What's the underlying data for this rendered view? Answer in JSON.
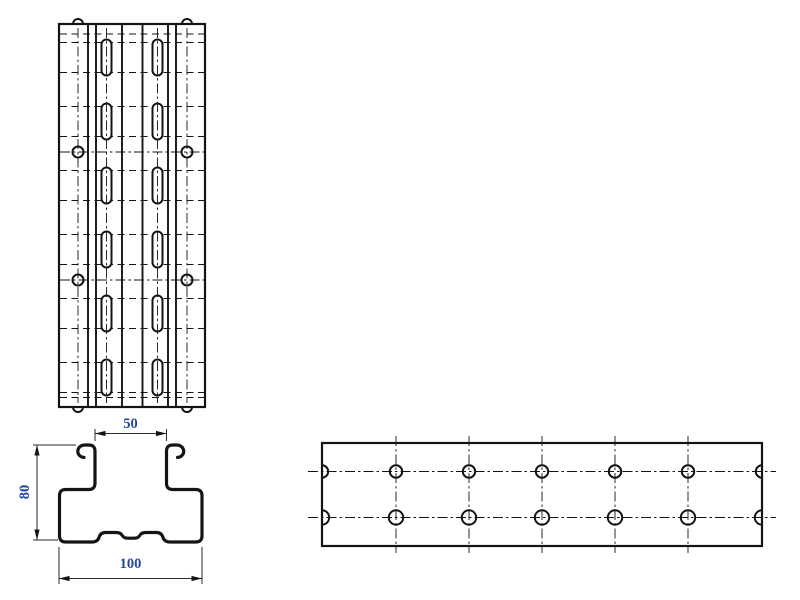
{
  "drawing": {
    "type": "engineering-orthographic-views",
    "line_color": "#141414",
    "dim_line_color": "#2a2a2a",
    "dim_text_color": "#24479b",
    "dimensions": {
      "top": {
        "label": "50"
      },
      "left": {
        "label": "80"
      },
      "bottom": {
        "label": "100"
      }
    },
    "plan_view": {
      "rect": {
        "x": 59,
        "y": 24,
        "w": 146,
        "h": 383
      },
      "solid_vertical_x": [
        88,
        96,
        122,
        142.5,
        168,
        176
      ],
      "slot_column_x": [
        106.5,
        157.5
      ],
      "slot_center_y": [
        57.5,
        121.5,
        185.5,
        249.5,
        313.5,
        377.5
      ],
      "slot_length": 36,
      "slot_width": 10,
      "slot_end_line_offset": 15,
      "extra_bend_y": [
        34,
        397.5
      ],
      "hole_column_x": [
        78,
        187
      ],
      "hole_row_y": [
        152,
        280
      ],
      "hole_radius": 5.5,
      "notch_x": [
        78,
        187
      ],
      "notch_radius": 5,
      "centerline_vertical_x": [
        78,
        106.5,
        157.5,
        187
      ]
    },
    "section_view": {
      "profile_path": "M 84,457.5 C 79,457 76.5,452.5 78.5,448.5 C 79.8,446.2 82,445 85,445 L 88.5,445 C 93,445 95,447 95,451.5 L 95,483 C 95,487.5 93,489.5 88.5,489.5 L 66,489.5 C 61.5,489.5 59.5,491.5 59.5,496 L 59.5,535.5 C 59.5,540 61.5,542 66,542 L 92,542 C 96,542 98,540.5 99,537.5 C 100,534.2 102,532.5 105.5,532.5 L 116,532.5 C 119.5,532.5 121.5,533.8 122.5,535.8 C 123.5,537.4 125,538.2 128,538.2 L 134,538.2 C 137,538.2 138.5,537.4 139.5,535.8 C 140.5,533.8 142.5,532.5 146,532.5 L 156.5,532.5 C 160,532.5 162,534.2 163,537.5 C 164,540.5 166,542 170,542 L 195.5,542 C 200,542 202,540 202,535.5 L 202,496 C 202,491.5 200,489.5 195.5,489.5 L 173,489.5 C 168.5,489.5 166.5,487.5 166.5,483 L 166.5,451.5 C 166.5,447 168.5,445 173,445 L 176.5,445 C 179.5,445 181.7,446.2 183,448.5 C 185,452.5 182.5,457 177.5,457.5",
      "dim_top": {
        "x1": 95,
        "x2": 166.5,
        "line_y": 433.5,
        "ext_y1": 441,
        "ext_y2": 429,
        "text_x": 130.5,
        "text_y": 428
      },
      "dim_left": {
        "y1": 445,
        "y2": 540,
        "line_x": 37,
        "ext_x_end": 33,
        "ext_top_from": 76,
        "ext_bot_from": 58,
        "text_x": 29,
        "text_y": 492
      },
      "dim_bottom": {
        "x1": 59,
        "x2": 202,
        "line_y": 578.5,
        "ext_y1": 547,
        "ext_y2": 584,
        "text_x": 130.5,
        "text_y": 568
      }
    },
    "side_view": {
      "rect": {
        "x": 322,
        "y": 443,
        "w": 440,
        "h": 103
      },
      "row_y": [
        471.5,
        517.5
      ],
      "row_radius": [
        6.2,
        7.2
      ],
      "column_x": [
        396,
        469,
        542,
        615,
        688
      ],
      "h_centerline": {
        "x1": 308,
        "x2": 776
      },
      "v_centerline": {
        "y1": 436,
        "y2": 553
      }
    }
  }
}
